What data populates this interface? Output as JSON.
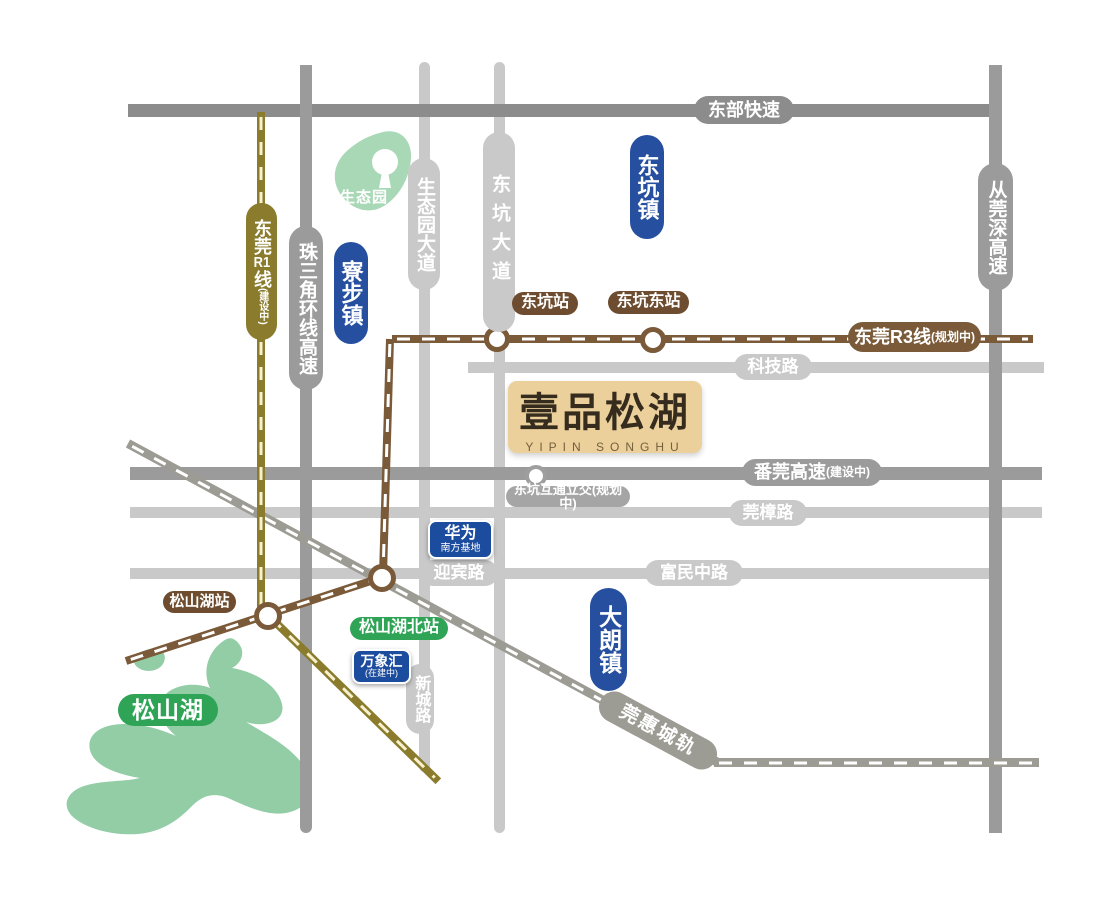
{
  "project": {
    "name": "壹品松湖",
    "name_en": "YIPIN SONGHU"
  },
  "towns": {
    "dongkeng": "东坑镇",
    "liaobu": "寮步镇",
    "dalang": "大朗镇"
  },
  "roads": {
    "dongbu": "东部快速",
    "congguanshen": "从莞深高速",
    "zhusanjiao": "珠三角环线高速",
    "fanguan": "番莞高速",
    "fanguan_status": "(建设中)",
    "keji": "科技路",
    "guanzhang": "莞樟路",
    "yingbin": "迎宾路",
    "fuminzhong": "富民中路",
    "shengtaiyuan_dadao": "生态园大道",
    "dongkeng_dadao": "东坑大道",
    "xincheng": "新城路"
  },
  "rails": {
    "r1_prefix": "东莞",
    "r1_num": "R1",
    "r1_suffix": "线",
    "r1_status": "(建设中)",
    "r3_name": "东莞R3线",
    "r3_status": "(规划中)",
    "guanhui": "莞惠城轨"
  },
  "stations": {
    "dongkeng": "东坑站",
    "dongkeng_east": "东坑东站",
    "songshanhu": "松山湖站",
    "songshanhu_north": "松山湖北站"
  },
  "pois": {
    "interchange": "东坑互通立交(规划中)",
    "huawei_name": "华为",
    "huawei_sub": "南方基地",
    "wanxianghui_name": "万象汇",
    "wanxianghui_status": "(在建中)",
    "eco_park": "生态园",
    "lake": "松山湖"
  },
  "colors": {
    "road_dark": "#8c8c8c",
    "road_mid": "#9b9b9b",
    "road_light": "#c9c9c9",
    "rail_gray": "#9c9c94",
    "rail_olive": "#8a7c2c",
    "rail_brown": "#7a5a39",
    "station_brown": "#6d4c2f",
    "badge_blue": "#26509f",
    "badge_green": "#2fa457",
    "park_green": "#a9d8b7",
    "lake_green": "#92cda6",
    "project_tan": "#ebd09c"
  }
}
